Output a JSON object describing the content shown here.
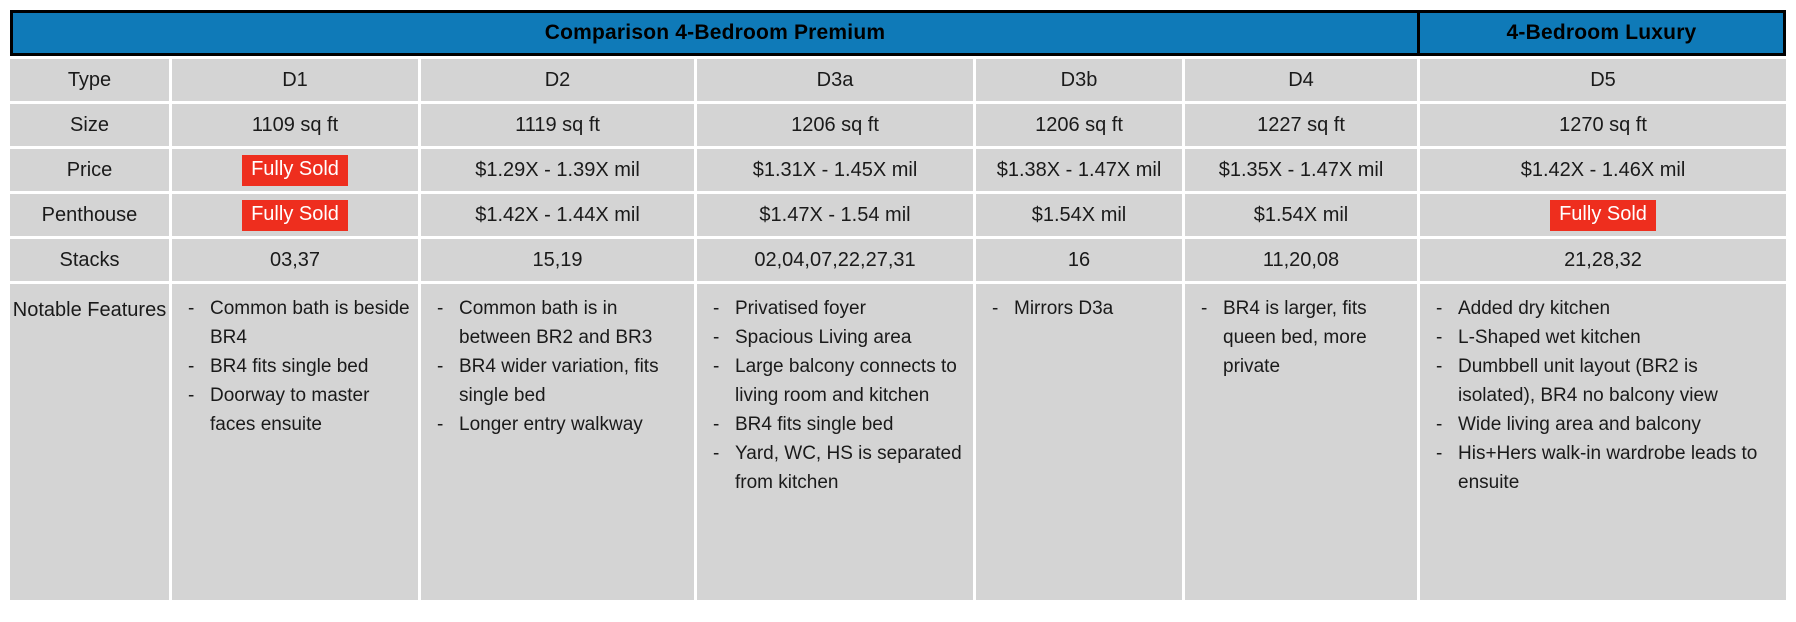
{
  "header": {
    "premium": "Comparison 4-Bedroom Premium",
    "luxury": "4-Bedroom Luxury"
  },
  "row_labels": {
    "type": "Type",
    "size": "Size",
    "price": "Price",
    "penthouse": "Penthouse",
    "stacks": "Stacks",
    "features": "Notable Features"
  },
  "sold_label": "Fully Sold",
  "colors": {
    "header_blue": "#0f7ab8",
    "cell_gray": "#d4d4d4",
    "sold_red": "#ee2e1e",
    "border_black": "#000000",
    "text_black": "#1a1a1a"
  },
  "units": [
    {
      "type": "D1",
      "size": "1109 sq ft",
      "price": {
        "sold": true,
        "text": "Fully Sold"
      },
      "penthouse": {
        "sold": true,
        "text": "Fully Sold"
      },
      "stacks": "03,37",
      "features": [
        "Common bath is beside BR4",
        "BR4 fits single bed",
        "Doorway to master faces ensuite"
      ]
    },
    {
      "type": "D2",
      "size": "1119 sq ft",
      "price": {
        "sold": false,
        "text": "$1.29X - 1.39X mil"
      },
      "penthouse": {
        "sold": false,
        "text": "$1.42X - 1.44X mil"
      },
      "stacks": "15,19",
      "features": [
        "Common bath is in between BR2 and BR3",
        "BR4 wider variation, fits single bed",
        "Longer entry walkway"
      ]
    },
    {
      "type": "D3a",
      "size": "1206 sq ft",
      "price": {
        "sold": false,
        "text": "$1.31X - 1.45X mil"
      },
      "penthouse": {
        "sold": false,
        "text": "$1.47X - 1.54 mil"
      },
      "stacks": "02,04,07,22,27,31",
      "features": [
        "Privatised foyer",
        "Spacious Living area",
        "Large balcony connects to living room and kitchen",
        "BR4 fits single bed",
        "Yard, WC, HS is separated from kitchen"
      ]
    },
    {
      "type": "D3b",
      "size": "1206 sq ft",
      "price": {
        "sold": false,
        "text": "$1.38X - 1.47X mil"
      },
      "penthouse": {
        "sold": false,
        "text": "$1.54X mil"
      },
      "stacks": "16",
      "features": [
        "Mirrors D3a"
      ]
    },
    {
      "type": "D4",
      "size": "1227 sq ft",
      "price": {
        "sold": false,
        "text": "$1.35X - 1.47X mil"
      },
      "penthouse": {
        "sold": false,
        "text": "$1.54X mil"
      },
      "stacks": "11,20,08",
      "features": [
        "BR4 is larger, fits queen bed, more private"
      ]
    },
    {
      "type": "D5",
      "size": "1270 sq ft",
      "price": {
        "sold": false,
        "text": "$1.42X - 1.46X mil"
      },
      "penthouse": {
        "sold": true,
        "text": "Fully Sold"
      },
      "stacks": "21,28,32",
      "features": [
        "Added dry kitchen",
        "L-Shaped wet kitchen",
        "Dumbbell unit layout (BR2 is isolated), BR4 no balcony view",
        "Wide living area and balcony",
        "His+Hers walk-in wardrobe leads to ensuite"
      ]
    }
  ]
}
